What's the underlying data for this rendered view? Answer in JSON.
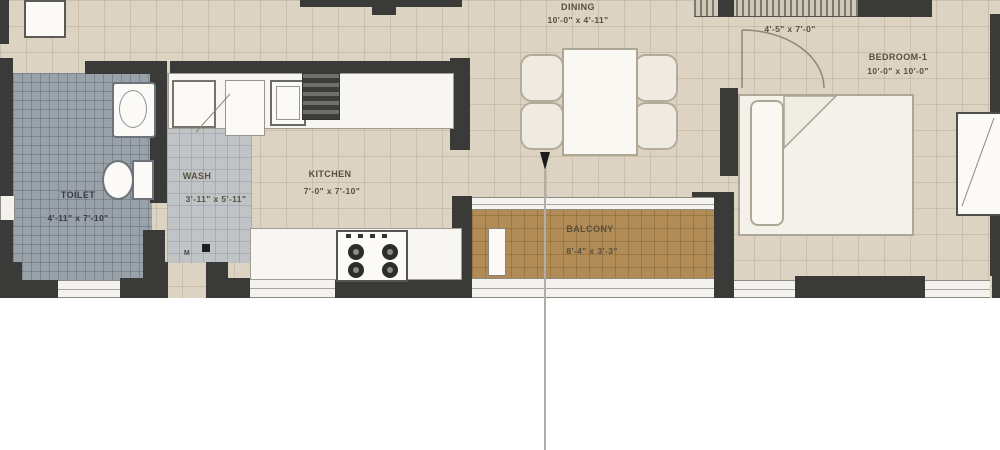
{
  "plan_title": "apartment-floor-plan",
  "rooms": {
    "dining": {
      "label": "DINING",
      "dims": "10'-0\" x 4'-11\""
    },
    "passage": {
      "label": "",
      "dims": "4'-5\" x 7'-0\""
    },
    "bedroom1": {
      "label": "BEDROOM-1",
      "dims": "10'-0\" x 10'-0\""
    },
    "toilet": {
      "label": "TOILET",
      "dims": "4'-11\" x 7'-10\""
    },
    "wash": {
      "label": "WASH",
      "dims": "3'-11\" x 5'-11\""
    },
    "kitchen": {
      "label": "KITCHEN",
      "dims": "7'-0\" x 7'-10\""
    },
    "balcony": {
      "label": "BALCONY",
      "dims": "8'-4\" x 3'-3\""
    }
  },
  "annotations": {
    "door_tag": "M"
  },
  "colors": {
    "wall": "#3a3a38",
    "floor": "#dcd3c2",
    "toilet_floor": "#99a1a9",
    "wash_floor": "#c1c4c7",
    "balcony_floor": "#b18c56",
    "counter": "#f7f6f2",
    "label_text": "#57503e"
  }
}
